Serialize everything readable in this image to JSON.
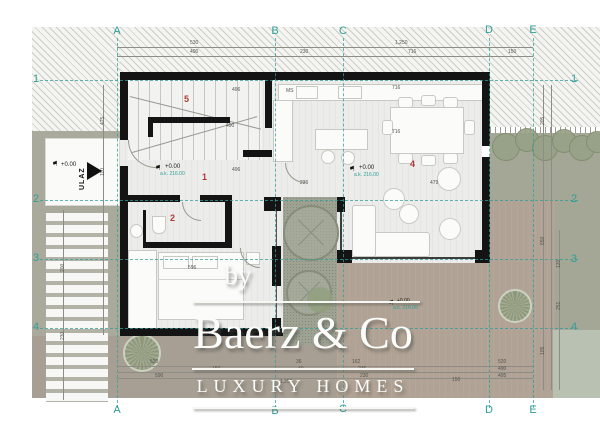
{
  "plan": {
    "grid_columns": [
      "A",
      "B",
      "C",
      "D",
      "E"
    ],
    "grid_rows": [
      "1",
      "2",
      "3",
      "4"
    ],
    "entrance_label": "ULAZ",
    "rooms": {
      "stair_hall": "5",
      "hallway": "1",
      "bathroom": "2",
      "living_room": "4"
    },
    "levels": {
      "entry": {
        "level": "+0.00"
      },
      "hallway": {
        "level": "+0.00",
        "absolute": "a.k. 216.00"
      },
      "living": {
        "level": "+0.00",
        "absolute": "a.k. 216.00"
      },
      "terrace": {
        "level": "+0.00",
        "absolute": "a.k. 216.00"
      }
    },
    "kitchen": {
      "counter_label": "MS"
    },
    "dims": {
      "top1": [
        "530",
        "1,250"
      ],
      "top2": [
        "490",
        "230",
        "716",
        "150"
      ],
      "bot1": [
        "530",
        "36",
        "162",
        "520"
      ],
      "bot2": [
        "150",
        "40",
        "236",
        "490"
      ],
      "bot3": [
        "590",
        "230",
        "495"
      ],
      "bot4": [
        "1,250",
        "150"
      ],
      "left": [
        "475",
        "110",
        "200",
        "230"
      ],
      "right": [
        "205",
        "650",
        "120",
        "251",
        "105"
      ],
      "inner": [
        "716",
        "716",
        "236",
        "479",
        "496",
        "490",
        "496",
        "596"
      ]
    }
  },
  "icons": {
    "level_flag": "⚑"
  },
  "watermark": {
    "prefix": "by",
    "brand": "Baerz & Co",
    "tagline": "LUXURY HOMES"
  },
  "colors": {
    "wall": "#141414",
    "grid_teal": "#2f9e98",
    "room_number_red": "#ae3b35",
    "garden_olive": "#a9aa9c",
    "terrace_brown": "#b0a294",
    "patio_green": "#9da292",
    "watermark_white": "#fcfcfa"
  }
}
